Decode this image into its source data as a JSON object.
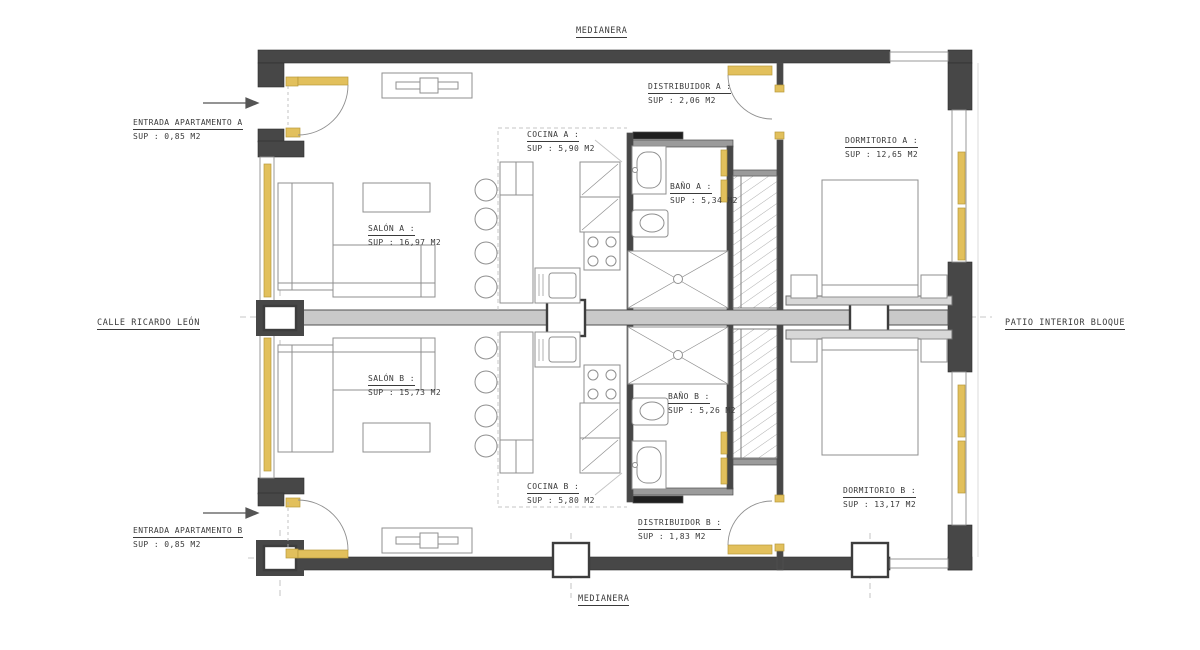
{
  "drawing": {
    "type": "architectural floor plan - two mirrored apartments",
    "site_labels": {
      "top": "MEDIANERA",
      "bottom": "MEDIANERA",
      "left": "CALLE RICARDO LEÓN",
      "right": "PATIO INTERIOR BLOQUE"
    },
    "rooms": {
      "entrada_a": {
        "name": "ENTRADA APARTAMENTO A",
        "sup": "SUP : 0,85 M2"
      },
      "entrada_b": {
        "name": "ENTRADA APARTAMENTO B",
        "sup": "SUP : 0,85 M2"
      },
      "distribuidor_a": {
        "name": "DISTRIBUIDOR  A :",
        "sup": "SUP : 2,06 M2"
      },
      "distribuidor_b": {
        "name": "DISTRIBUIDOR  B :",
        "sup": "SUP : 1,83 M2"
      },
      "cocina_a": {
        "name": "COCINA A :",
        "sup": "SUP : 5,90 M2"
      },
      "cocina_b": {
        "name": "COCINA B :",
        "sup": "SUP : 5,80 M2"
      },
      "salon_a": {
        "name": "SALÓN A :",
        "sup": "SUP : 16,97 M2"
      },
      "salon_b": {
        "name": "SALÓN B :",
        "sup": "SUP : 15,73 M2"
      },
      "bano_a": {
        "name": "BAÑO A :",
        "sup": "SUP : 5,34 M2"
      },
      "bano_b": {
        "name": "BAÑO B :",
        "sup": "SUP : 5,26 M2"
      },
      "dormitorio_a": {
        "name": "DORMITORIO A :",
        "sup": "SUP : 12,65 M2"
      },
      "dormitorio_b": {
        "name": "DORMITORIO B :",
        "sup": "SUP : 13,17 M2"
      }
    },
    "icons": {
      "entrance_a_arrow": "arrow-right-icon",
      "entrance_b_arrow": "arrow-right-icon"
    },
    "colors": {
      "wall": "#474747",
      "partition": "#9b9b9b",
      "spine_fill": "#c9c9c9",
      "furniture_line": "#8f8f8f",
      "highlight_yellow": "#e2c05c",
      "background": "#ffffff"
    }
  }
}
